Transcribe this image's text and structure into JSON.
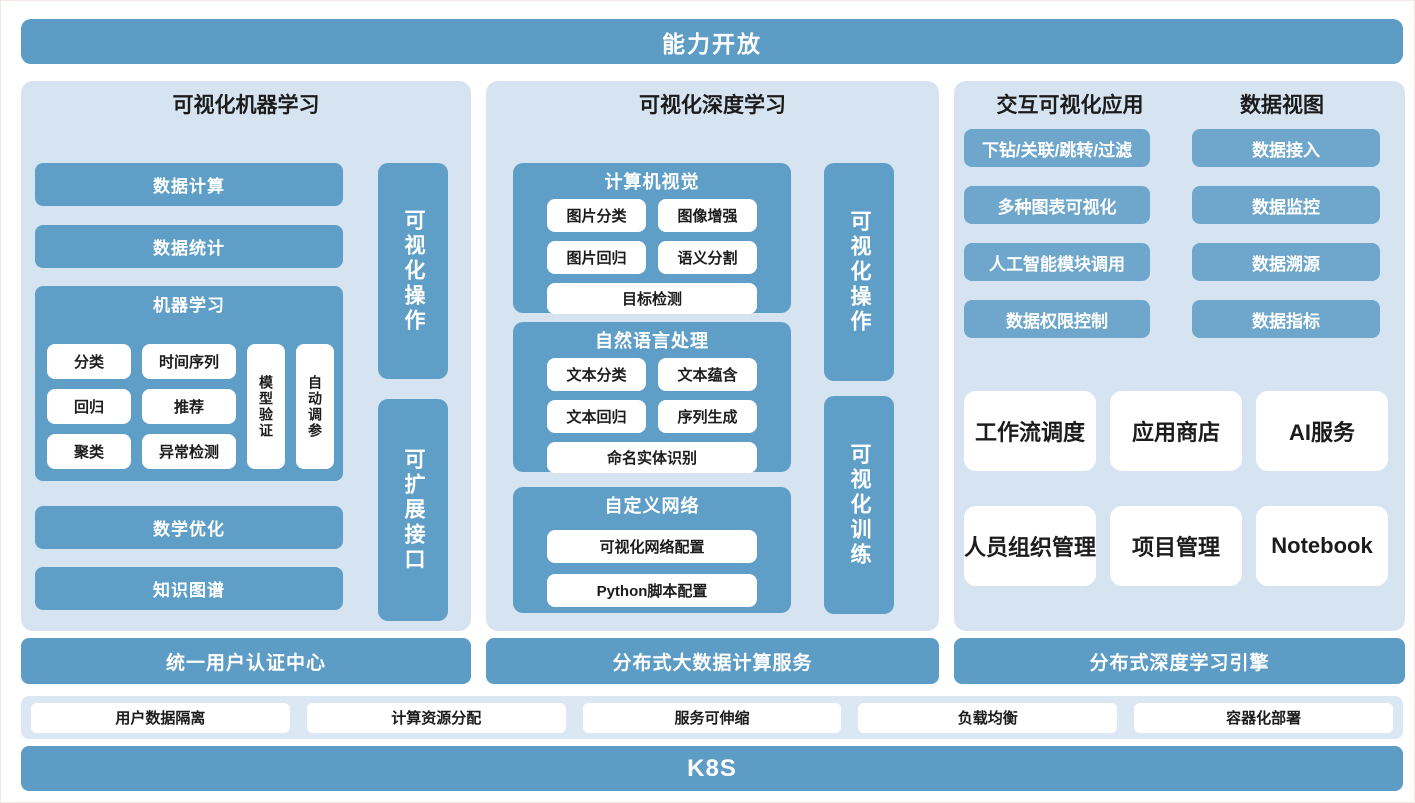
{
  "colors": {
    "bar_blue": "#5d9cc4",
    "box_blue": "#5f9fc7",
    "button_blue": "#6fa7cc",
    "panel_bg": "#d6e4f2",
    "band_bg": "#dbe7f3",
    "pill_bg": "#ffffff",
    "text_dark": "#1c1c1c",
    "text_white": "#ffffff"
  },
  "banner": {
    "title": "能力开放"
  },
  "left": {
    "title": "可视化机器学习",
    "box1": "数据计算",
    "box2": "数据统计",
    "ml": {
      "title": "机器学习",
      "pills": [
        "分类",
        "时间序列",
        "回归",
        "推荐",
        "聚类",
        "异常检测"
      ],
      "vpills": [
        "模型验证",
        "自动调参"
      ]
    },
    "box3": "数学优化",
    "box4": "知识图谱",
    "vbars": [
      "可视化操作",
      "可扩展接口"
    ]
  },
  "middle": {
    "title": "可视化深度学习",
    "cv": {
      "title": "计算机视觉",
      "pills": [
        "图片分类",
        "图像增强",
        "图片回归",
        "语义分割"
      ],
      "wide": "目标检测"
    },
    "nlp": {
      "title": "自然语言处理",
      "pills": [
        "文本分类",
        "文本蕴含",
        "文本回归",
        "序列生成"
      ],
      "wide": "命名实体识别"
    },
    "custom": {
      "title": "自定义网络",
      "wide1": "可视化网络配置",
      "wide2": "Python脚本配置"
    },
    "vbars": [
      "可视化操作",
      "可视化训练"
    ]
  },
  "right": {
    "title_left": "交互可视化应用",
    "title_right": "数据视图",
    "buttons_left": [
      "下钻/关联/跳转/过滤",
      "多种图表可视化",
      "人工智能模块调用",
      "数据权限控制"
    ],
    "buttons_right": [
      "数据接入",
      "数据监控",
      "数据溯源",
      "数据指标"
    ],
    "cards": [
      "工作流调度",
      "应用商店",
      "AI服务",
      "人员组织管理",
      "项目管理",
      "Notebook"
    ]
  },
  "services": [
    "统一用户认证中心",
    "分布式大数据计算服务",
    "分布式深度学习引擎"
  ],
  "infra": [
    "用户数据隔离",
    "计算资源分配",
    "服务可伸缩",
    "负载均衡",
    "容器化部署"
  ],
  "k8s": {
    "title": "K8S"
  }
}
